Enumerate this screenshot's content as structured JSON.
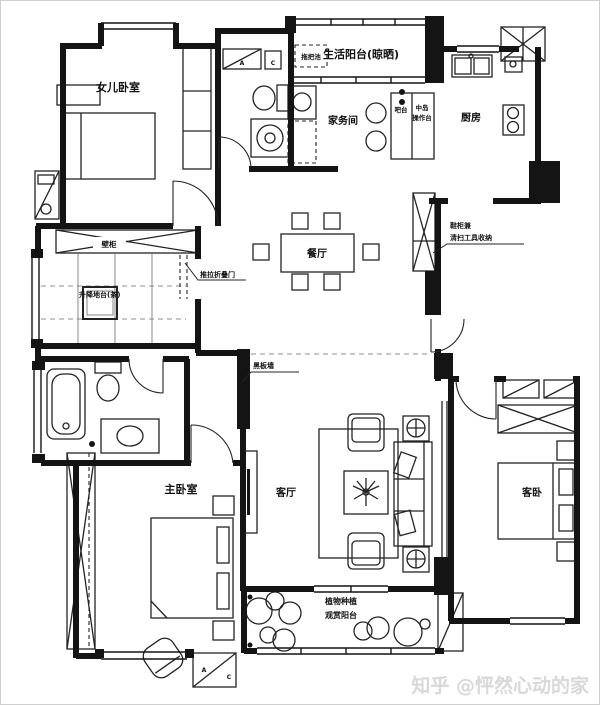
{
  "meta": {
    "watermark": "知乎 @怦然心动的家",
    "type_label": "apartment floor plan"
  },
  "colors": {
    "ink": "#141414",
    "watermark": "#d8d8d8",
    "background": "#ffffff"
  },
  "rooms": {
    "daughter_bedroom": "女儿卧室",
    "life_balcony": "生活阳台(晾晒)",
    "housework_room": "家务间",
    "kitchen": "厨房",
    "dining_room": "餐厅",
    "living_room": "客厅",
    "master_bedroom": "主卧室",
    "guest_bedroom": "客卧",
    "plant_balcony_line1": "植物种植",
    "plant_balcony_line2": "观赏阳台"
  },
  "fixtures": {
    "mop_sink": "拖把池",
    "bar_counter": "吧台",
    "island_line1": "中岛",
    "island_line2": "操作台",
    "wall_cabinet": "壁柜",
    "tea_platform": "升降地台(茶)",
    "ac_a": "A",
    "ac_c": "C"
  },
  "annotations": {
    "folding_door": "推拉折叠门",
    "shoe_cabinet_line1": "鞋柜兼",
    "shoe_cabinet_line2": "清扫工具收纳",
    "blackboard_wall": "黑板墙"
  }
}
